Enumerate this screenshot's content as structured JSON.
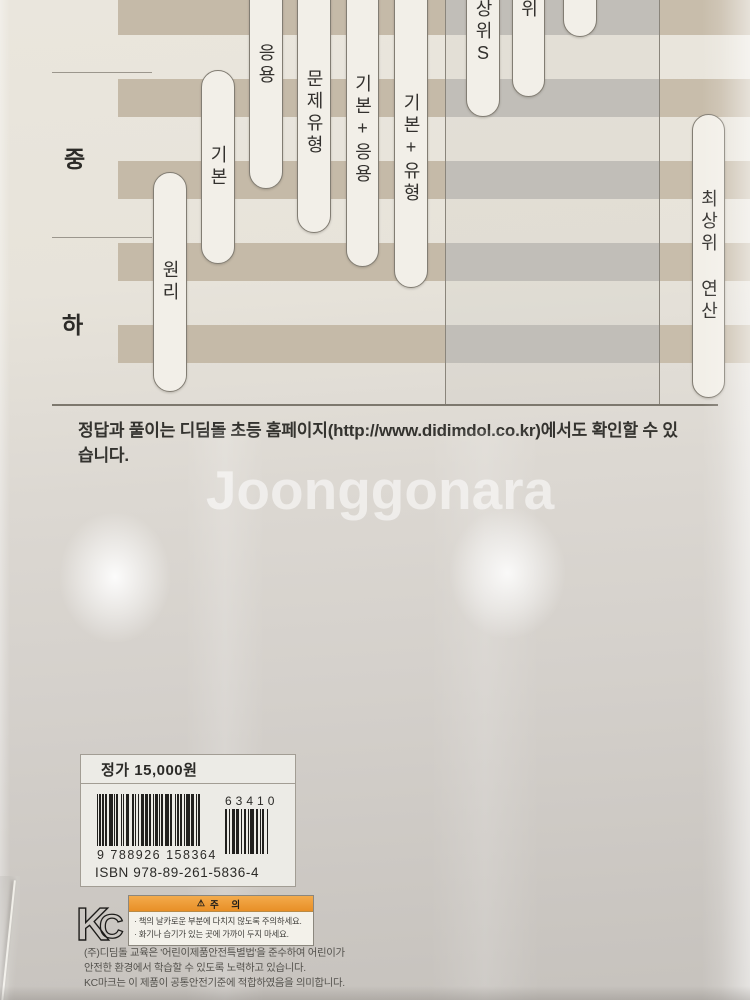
{
  "watermark": "Joonggonara",
  "chart_data": {
    "type": "bar",
    "subtype": "difficulty-level-range-chart",
    "title": "",
    "row_labels": [
      "중",
      "하"
    ],
    "grid": "striped-horizontal-bands",
    "legend_position": "none",
    "items": [
      {
        "label": "원리",
        "top_cut": false,
        "span_px": [
          172,
          392
        ]
      },
      {
        "label": "기본",
        "top_cut": false,
        "span_px": [
          70,
          264
        ]
      },
      {
        "label": "응용",
        "top_cut": true,
        "span_px": [
          0,
          189
        ]
      },
      {
        "label": "문제유형",
        "top_cut": true,
        "span_px": [
          0,
          233
        ]
      },
      {
        "label": "기본+응용",
        "top_cut": true,
        "span_px": [
          0,
          267
        ]
      },
      {
        "label": "기본+유형",
        "top_cut": true,
        "span_px": [
          0,
          288
        ]
      },
      {
        "label": "상위S",
        "top_cut": true,
        "span_px": [
          0,
          117
        ]
      },
      {
        "label": "위",
        "top_cut": true,
        "span_px": [
          0,
          97
        ]
      },
      {
        "label": "",
        "top_cut": true,
        "span_px": [
          0,
          37
        ]
      },
      {
        "label": "최상위 연산",
        "top_cut": false,
        "span_px": [
          114,
          398
        ]
      }
    ]
  },
  "footer_note": "정답과 풀이는 디딤돌 초등 홈페이지(http://www.didimdol.co.kr)에서도 확인할 수 있습니다.",
  "price_box": {
    "price": "정가 15,000원",
    "addon_code": "63410",
    "ean_digits": "9 788926 158364",
    "isbn": "ISBN 978-89-261-5836-4"
  },
  "certification": {
    "kc_label": "KC",
    "warning_title": "주 의",
    "warnings": [
      "책의 날카로운 부분에 다치지 않도록 주의하세요.",
      "화기나 습기가 있는 곳에 가까이 두지 마세요."
    ],
    "notice_lines": [
      "(주)디딤돌 교육은 '어린이제품안전특별법'을 준수하여 어린이가",
      "안전한 환경에서 학습할 수 있도록 노력하고 있습니다.",
      "KC마크는 이 제품이 공통안전기준에 적합하였음을 의미합니다."
    ]
  }
}
